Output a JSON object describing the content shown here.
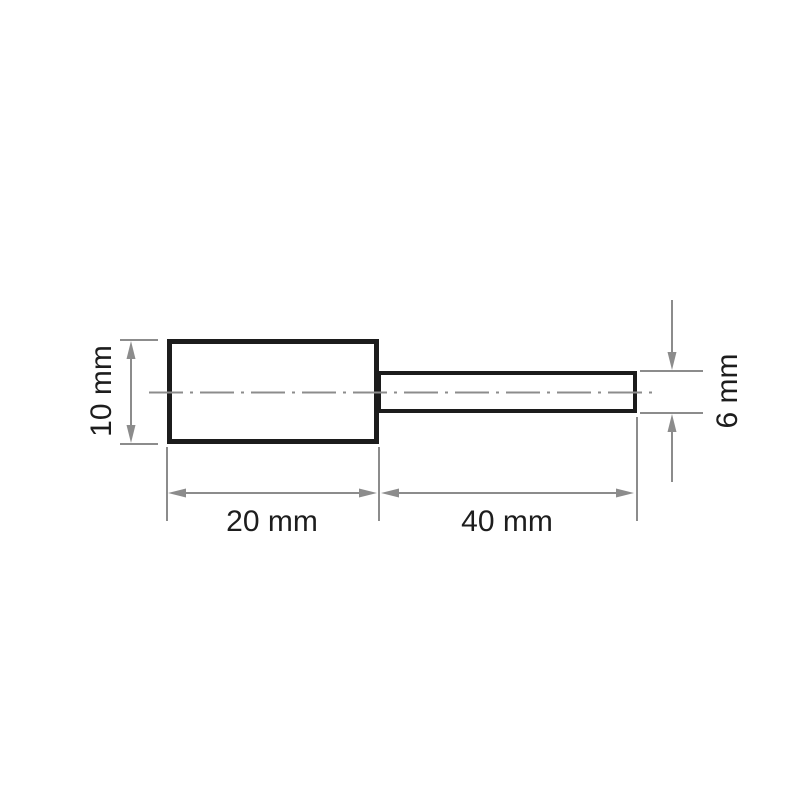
{
  "colors": {
    "outline": "#1c1c1c",
    "dimension": "#8c8c8c",
    "label": "#1d1d1d",
    "background": "#ffffff"
  },
  "drawing": {
    "type": "technical-dimension-drawing",
    "part": "cylindrical-grinding-pin-with-shank",
    "labels": {
      "body_height": "10 mm",
      "body_length": "20 mm",
      "shank_length": "40 mm",
      "shank_diameter": "6 mm"
    },
    "values": {
      "body_height_mm": 10,
      "body_length_mm": 20,
      "shank_length_mm": 40,
      "shank_diameter_mm": 6
    }
  }
}
